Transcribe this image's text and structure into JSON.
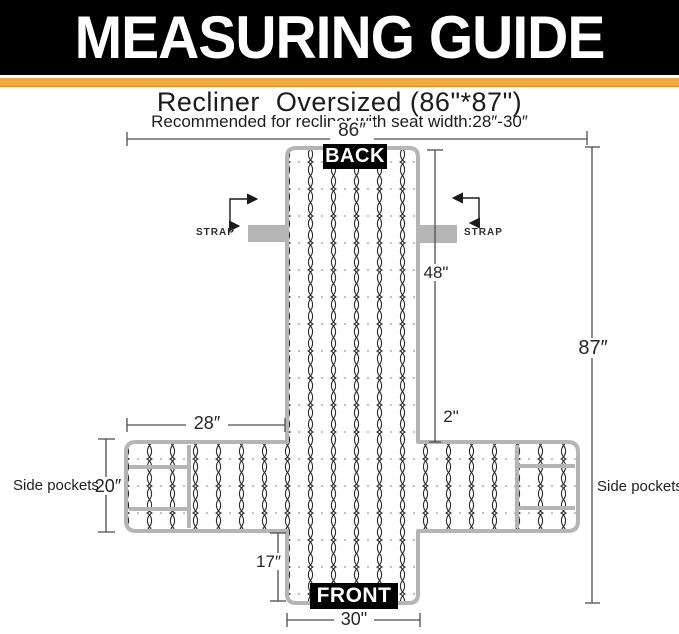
{
  "header": {
    "title": "MEASURING GUIDE"
  },
  "product": {
    "title": "Recliner  Oversized (86\"*87\")",
    "subtitle": "Recommended for recliner with seat width:28″-30″"
  },
  "diagram": {
    "back_label": "BACK",
    "front_label": "FRONT",
    "strap_left_label": "STRAP",
    "strap_right_label": "STRAP",
    "side_pockets_left_label": "Side pockets",
    "side_pockets_right_label": "Side pockets",
    "dims": {
      "total_width": "86″",
      "total_height": "87″",
      "back_height": "48\"",
      "seat_gap": "2\"",
      "arm_span": "28″",
      "side_height": "20″",
      "front_drop": "17″",
      "front_width": "30\""
    },
    "colors": {
      "banner_black": "#000000",
      "accent_orange": "#EFA93F",
      "cover_border_gray": "#B5B5B5",
      "strap_gray": "#B5B5B5",
      "pattern_line": "#2B2B2B",
      "dimension_line": "#4D4D4D"
    }
  }
}
